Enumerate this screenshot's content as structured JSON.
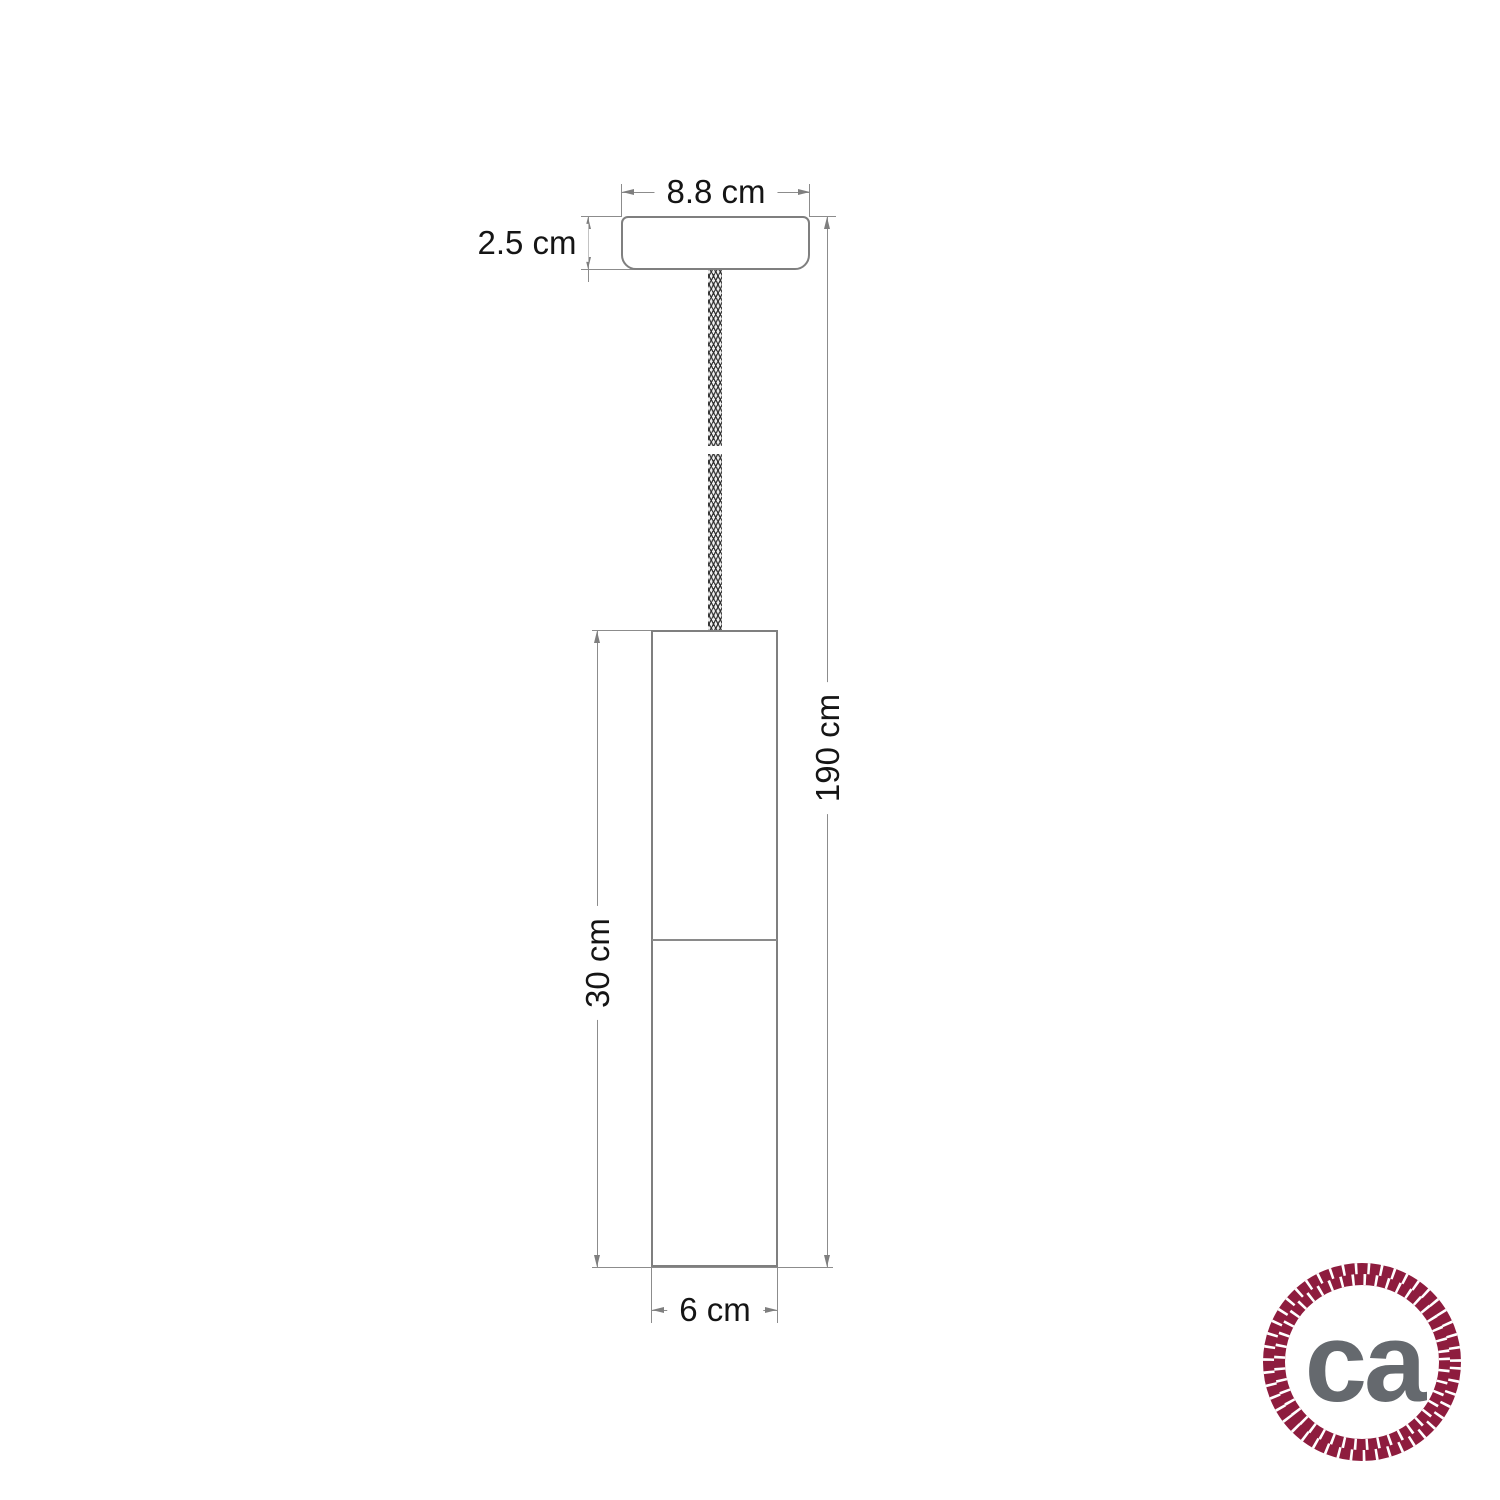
{
  "diagram": {
    "title": "pendant-lamp-dimension-drawing",
    "dimensions": {
      "canopy_width": "8.8 cm",
      "canopy_height": "2.5 cm",
      "total_drop": "190 cm",
      "shade_height": "30 cm",
      "shade_diameter": "6 cm"
    },
    "colors": {
      "outline_gray": "#7f7f7f",
      "dimension_gray": "#8c8c8c",
      "label_black": "#151515"
    }
  },
  "logo": {
    "text": "ca",
    "rope_color": "#8e1c3e",
    "letters_color": "#65696e",
    "background": "#ffffff"
  }
}
